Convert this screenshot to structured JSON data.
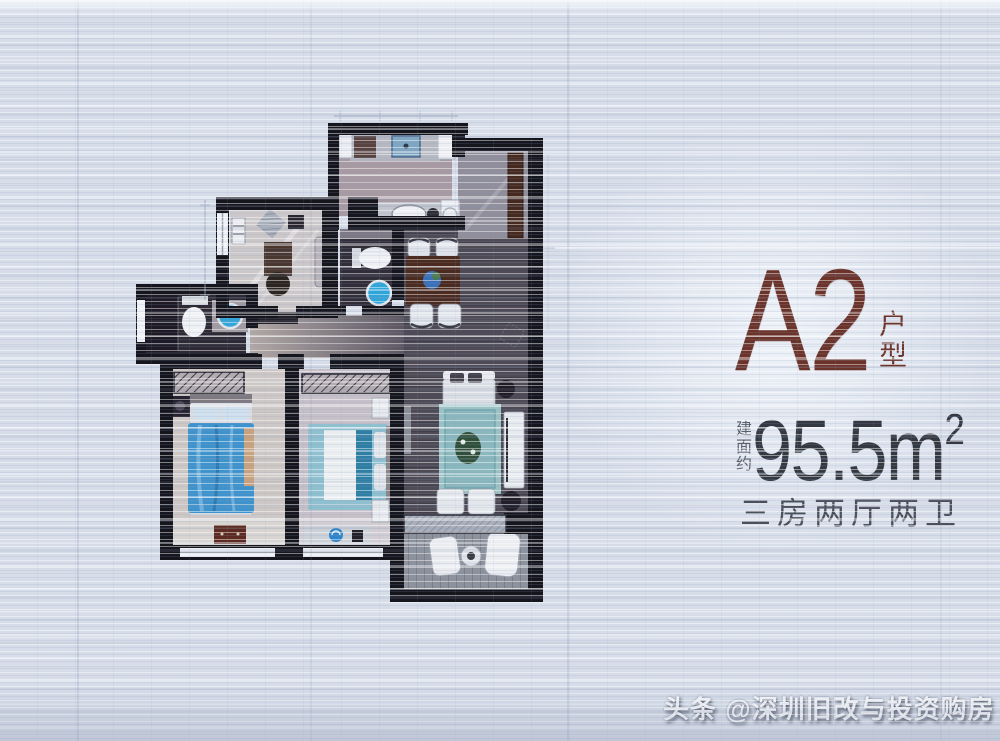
{
  "info_panel": {
    "unit_name": "A2",
    "unit_type_label": "户型",
    "area_prefix": "建面约",
    "area_value": "95.5",
    "area_unit": "m",
    "area_exponent": "2",
    "layout_summary": "三房两厅两卫"
  },
  "watermark": {
    "text": "头条 @深圳旧改与投资购房"
  },
  "colors": {
    "page_background": "#d6dde9",
    "accent_maroon": "#6b332a",
    "area_text": "#343841",
    "summary_text": "#4a4f5a",
    "wall": "#15151e",
    "bed_blue": "#3f93cc",
    "basin_blue": "#2ea6da",
    "watermark_text": "#f3f5f8"
  },
  "floor_plan": {
    "description": "A2 unit blueprint floor plan, three bedrooms, two living areas, two bathrooms",
    "rooms": [
      {
        "name": "kitchen"
      },
      {
        "name": "entry-hall"
      },
      {
        "name": "study"
      },
      {
        "name": "guest-bathroom"
      },
      {
        "name": "master-bathroom"
      },
      {
        "name": "dining-area"
      },
      {
        "name": "living-room"
      },
      {
        "name": "master-bedroom"
      },
      {
        "name": "second-bedroom"
      },
      {
        "name": "balcony"
      }
    ]
  }
}
